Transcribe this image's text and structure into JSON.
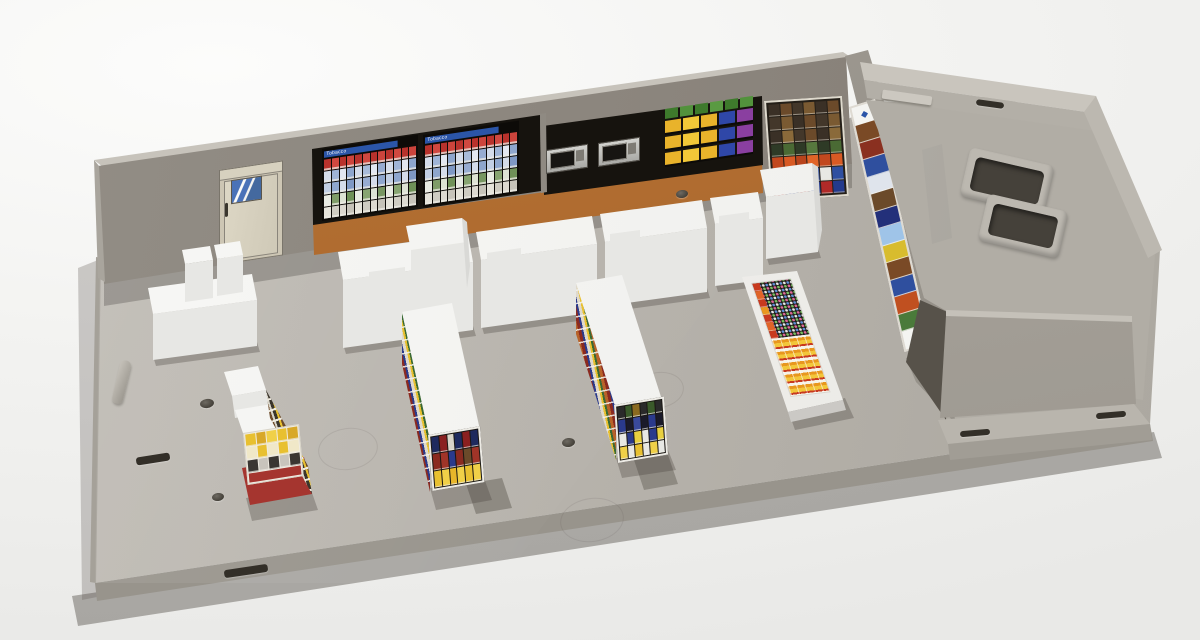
{
  "photo": {
    "subject": "Plastic model kit of a convenience store interior (N scale) on a gray base plate",
    "setting": "white studio background product photo"
  },
  "colors": {
    "base_plastic": "#b5b1aa",
    "base_front": "#98948c",
    "back_wall": "#8d8880",
    "wall_top_edge": "#c7c3bb",
    "counter_backdrop_orange": "#a96630",
    "decal_background_black": "#16130e",
    "door_beige": "#cdc6b4",
    "door_window_blue": "#4a72b8",
    "tobacco_header_blue": "#2b55a8",
    "cooler_logo_blue": "#2b55a8",
    "white_fixture": "#f4f4f2",
    "gondola_base_red": "#a5352f",
    "backroom_plastic": "#b3afa7",
    "hole_dark": "#332f28"
  },
  "back_wall": {
    "tobacco_label": "Tobacco",
    "rack_rows": [
      [
        "#b8322c",
        "#d04840",
        "#b8322c",
        "#cc443c",
        "#b8322c",
        "#d04840",
        "#b8322c",
        "#cc443c",
        "#b8322c",
        "#d04840",
        "#b8322c",
        "#cc443c"
      ],
      [
        "#d4dcea",
        "#9fb4d6",
        "#e2e7f1",
        "#8ea6cd",
        "#d4dcea",
        "#a8bbd9",
        "#e2e7f1",
        "#97acd1",
        "#d4dcea",
        "#9fb4d6",
        "#e2e7f1",
        "#8ea6cd"
      ],
      [
        "#c2cfe4",
        "#8ea6cd",
        "#d4dcea",
        "#7e98c4",
        "#c2cfe4",
        "#97acd1",
        "#d4dcea",
        "#8ea6cd",
        "#c2cfe4",
        "#8ea6cd",
        "#d4dcea",
        "#7e98c4"
      ],
      [
        "#e9ece4",
        "#7f9c68",
        "#dde3d4",
        "#6f9158",
        "#e9ece4",
        "#87a471",
        "#dde3d4",
        "#779661",
        "#e9ece4",
        "#87a471",
        "#dde3d4",
        "#6f9158"
      ],
      [
        "#e6e4db",
        "#cfccc2",
        "#dcd9d0",
        "#c6c3b9",
        "#e6e4db",
        "#cfccc2",
        "#dcd9d0",
        "#c6c3b9",
        "#e6e4db",
        "#cfccc2",
        "#dcd9d0",
        "#c6c3b9"
      ]
    ],
    "warmer_top_row": [
      "#3e7a2c",
      "#52923c",
      "#3e7a2c",
      "#5a9a42",
      "#3e7a2c",
      "#52923c"
    ],
    "warmer_row": [
      "#e9b32b",
      "#f2c838",
      "#e9b32b",
      "#2f47a8",
      "#8a3fa0"
    ]
  },
  "corner_shelf": {
    "rows": [
      [
        "#3a3026",
        "#6b4a2a",
        "#43372a",
        "#7a5a32",
        "#3a3026",
        "#6b4a2a"
      ],
      [
        "#43372a",
        "#7a5a32",
        "#3a3026",
        "#6b4a2a",
        "#43372a",
        "#7a5a32"
      ],
      [
        "#3a3026",
        "#8a6a3a",
        "#43372a",
        "#6b4a2a",
        "#3a3026",
        "#8a6a3a"
      ],
      [
        "#2e3a26",
        "#4a6a34",
        "#2e3a26",
        "#57783e",
        "#2e3a26",
        "#4a6a34"
      ],
      [
        "#c2481e",
        "#d85a24",
        "#b8441c",
        "#e06428",
        "#c2481e",
        "#d85a24"
      ],
      [
        "#e8e8e4",
        "#2f4fa0",
        "#e8e8e4",
        "#2f4fa0",
        "#e8e8e4",
        "#2f4fa0"
      ],
      [
        "#b02a28",
        "#243a8c",
        "#b02a28",
        "#243a8c",
        "#b02a28",
        "#243a8c"
      ]
    ]
  },
  "cooler": {
    "logo": "◆",
    "rows": [
      "#7a4a26",
      "#8a3020",
      "#2f4f9e",
      "#dfe4ec",
      "#6b4a2a",
      "#23307a",
      "#9fc4e8",
      "#d8bc2e",
      "#7a4a26",
      "#2f4f9e",
      "#c05020",
      "#4a7a3a"
    ]
  },
  "gondolas": {
    "candy_end_rows": [
      [
        "#e8c030",
        "#d8a828",
        "#f0d048",
        "#e8c030",
        "#d8a828"
      ],
      [
        "#f0e8c8",
        "#e8c030",
        "#f0e8c8",
        "#e8c030",
        "#f0e8c8"
      ],
      [
        "#3a3632",
        "#c8c4bc",
        "#3a3632",
        "#c8c4bc",
        "#3a3632"
      ]
    ],
    "mid_a_end_rows": [
      [
        "#1e2a5e",
        "#8a2020",
        "#d8d4c8",
        "#1e2a5e",
        "#8a2020",
        "#1e2a5e"
      ],
      [
        "#8a2a20",
        "#a03428",
        "#2a3a8c",
        "#8a2a20",
        "#6b4a2a",
        "#a03428"
      ],
      [
        "#e8c030",
        "#f0d048",
        "#e8b62a",
        "#f0d048",
        "#e8c030",
        "#f0d048"
      ]
    ],
    "mid_b_end_rows": [
      [
        "#2a2a2a",
        "#3a5a2a",
        "#8a6a20",
        "#2a2a2a",
        "#3a5a2a",
        "#2a2a2a"
      ],
      [
        "#2a3a8c",
        "#1a1a2a",
        "#3a4a9c",
        "#1a1a2a",
        "#2a3a8c",
        "#1a1a2a"
      ],
      [
        "#e8e8e4",
        "#2a3a8c",
        "#e8d040",
        "#e8e8e4",
        "#2a3a8c",
        "#e8d040"
      ],
      [
        "#f0d048",
        "#e8e8e4",
        "#e8c030",
        "#e8e8e4",
        "#f0d048",
        "#e8e8e4"
      ]
    ]
  },
  "flat_case": {
    "side_cells": [
      "#c83a1e",
      "#e06428",
      "#c83a1e",
      "#e8971e",
      "#c83a1e",
      "#e06428",
      "#c83a1e"
    ],
    "dot_colors": [
      "#e9e9e9",
      "#e06a9a",
      "#78c060",
      "#6090d8"
    ]
  }
}
